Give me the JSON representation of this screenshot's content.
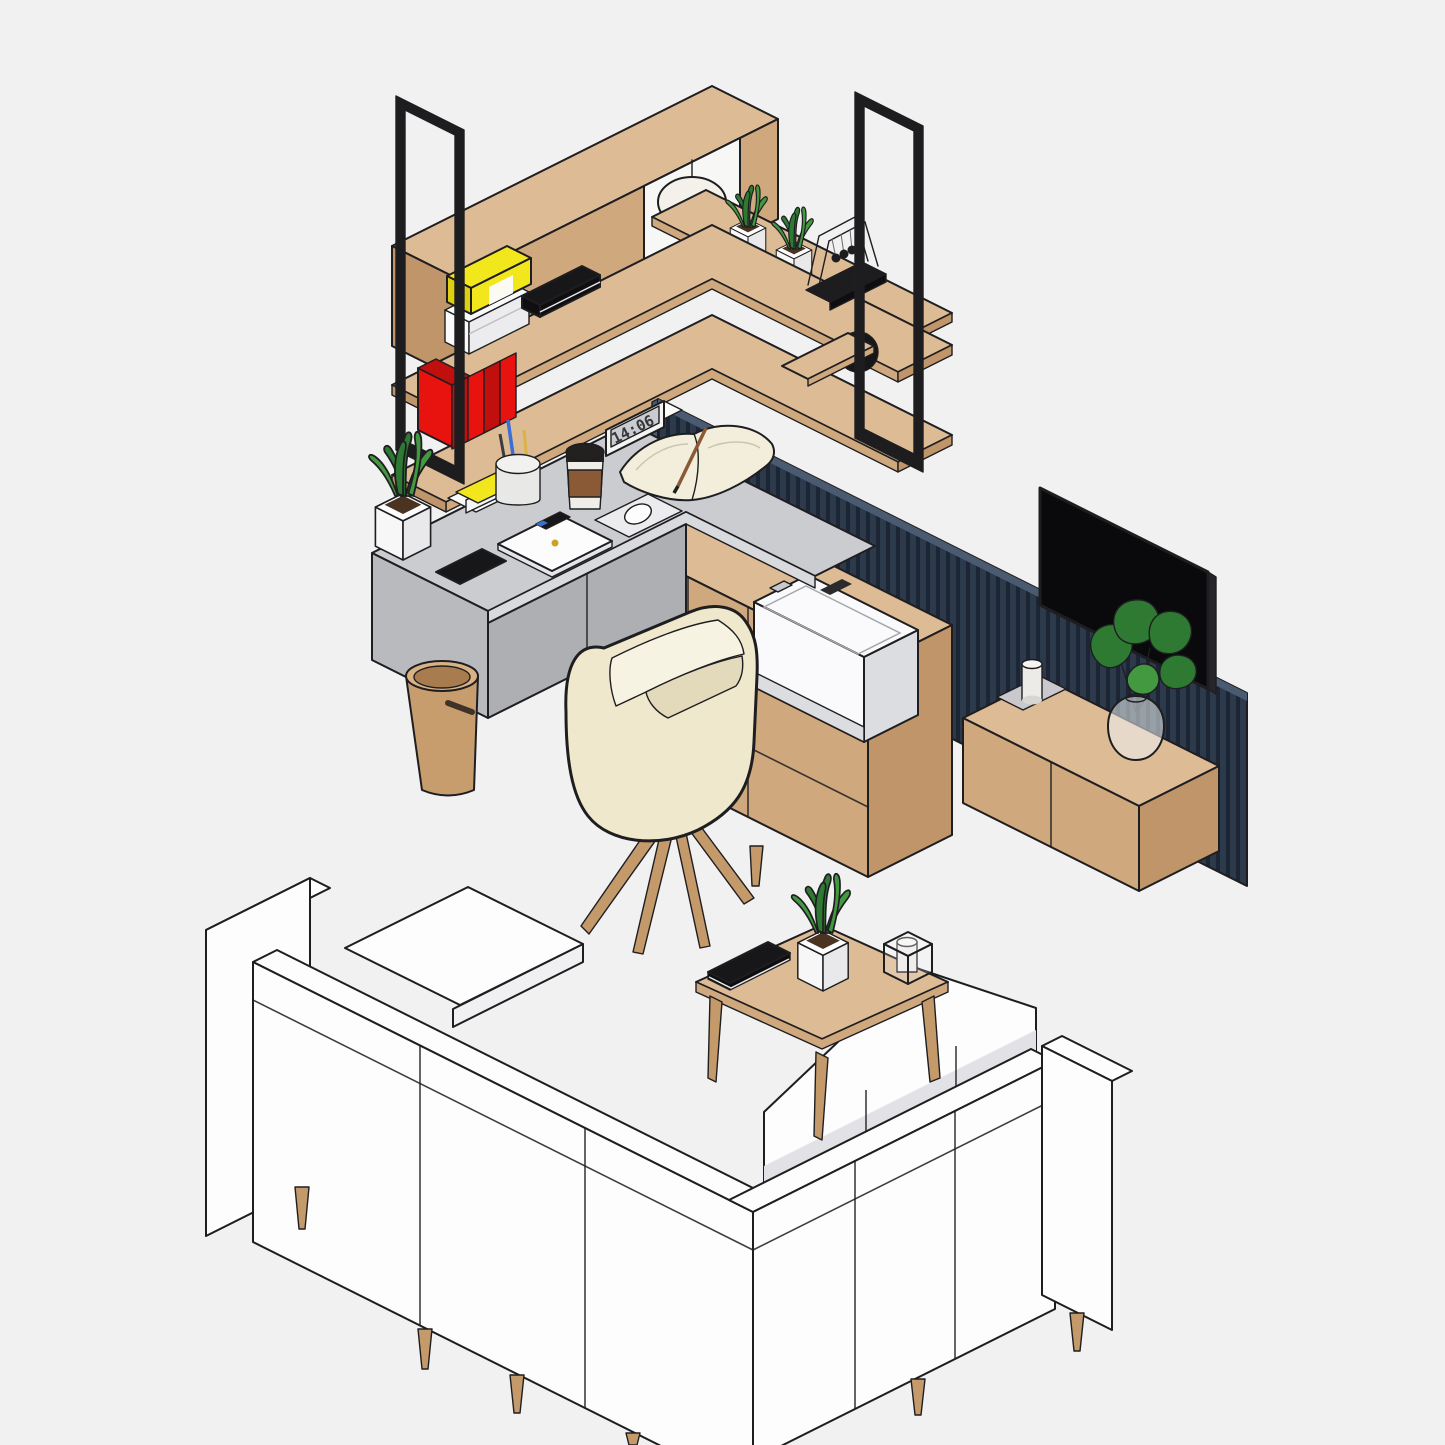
{
  "clock": {
    "time": "14:06"
  },
  "scene": {
    "type": "isometric-interior-illustration",
    "groups": [
      {
        "name": "wall-shelf-unit",
        "items": [
          "black-metal-frames",
          "wood-box-shelf",
          "dome-lamp",
          "two-snake-plant-planters",
          "yellow-binder",
          "paper-stack",
          "black-notebook",
          "newtons-cradle",
          "red-binders",
          "wood-board",
          "black-sphere-speaker"
        ]
      },
      {
        "name": "desk-area",
        "items": [
          "gray-l-desk",
          "digital-clock",
          "open-notebook-with-pencil",
          "coffee-cup",
          "pen-cup",
          "sticky-notes",
          "usb-stick",
          "white-laptop",
          "mouse-pad",
          "white-mouse",
          "smartphone",
          "snake-plant-planter",
          "waste-basket",
          "cream-swivel-chair",
          "wood-cabinet",
          "white-printer"
        ]
      },
      {
        "name": "media-wall",
        "items": [
          "navy-slat-panel",
          "flat-tv",
          "floating-wood-console",
          "candle-on-tray",
          "monstera-in-glass-vase"
        ]
      },
      {
        "name": "sofa-set",
        "items": [
          "white-l-sectional-sofa",
          "chaise-cushion",
          "wood-tapered-feet"
        ]
      },
      {
        "name": "coffee-table",
        "items": [
          "square-wood-table",
          "black-book",
          "snake-plant-planter",
          "candle-lantern"
        ]
      }
    ]
  },
  "colors": {
    "bg": "#f1f1f2",
    "outline": "#1e1e21",
    "wood-top": "#dcbb95",
    "wood-mid": "#cfa87e",
    "wood-dark": "#bf9569",
    "wood-leg": "#c59a6b",
    "frame-black": "#1d1d1f",
    "screen-black": "#0a0a0c",
    "desk-top": "#cbccd0",
    "desk-edge": "#d9dadd",
    "desk-front": "#aeafb3",
    "desk-end": "#b9babe",
    "wall-base": "#2d3a4b",
    "wall-slat": "#1b2534",
    "wall-edge": "#4a5a70",
    "chair-cream": "#efe8cd",
    "chair-shade": "#e2dabb",
    "chair-inner": "#f7f3e2",
    "sofa-white": "#fdfdfe",
    "sofa-shade": "#f0f0f2",
    "sofa-shadow": "#e2e2e6",
    "plant-dark": "#2e7a32",
    "plant-light": "#43993f",
    "planter-left": "#f7f7f7",
    "planter-right": "#e9e9eb",
    "planter-rim": "#fdfdfd",
    "soil": "#4a3321",
    "yellow": "#f2e71d",
    "yellow-side": "#ddd012",
    "red": "#e8130f",
    "red-dark": "#c00f0c",
    "page": "#f2eedb",
    "book-black": "#17171a",
    "sleeve": "#8a5a36",
    "lid": "#232120",
    "cup-white": "#f0eee8",
    "printer-white": "#fafafc",
    "printer-shade": "#dcdde1",
    "tray": "#c9c9cd",
    "lamp-white": "#f3f1ea",
    "candle": "#edebe8",
    "blue": "#3a6fd8",
    "pencil": "#d9b344",
    "digit": "#35363c",
    "gold": "#c9a227",
    "trash-top": "#d9b183",
    "trash-body": "#c89d6e",
    "trash-inner": "#a97c50",
    "slot-brown": "#3f3226",
    "glass": "#eef2f4",
    "page-edge": "#e8e8e8"
  }
}
